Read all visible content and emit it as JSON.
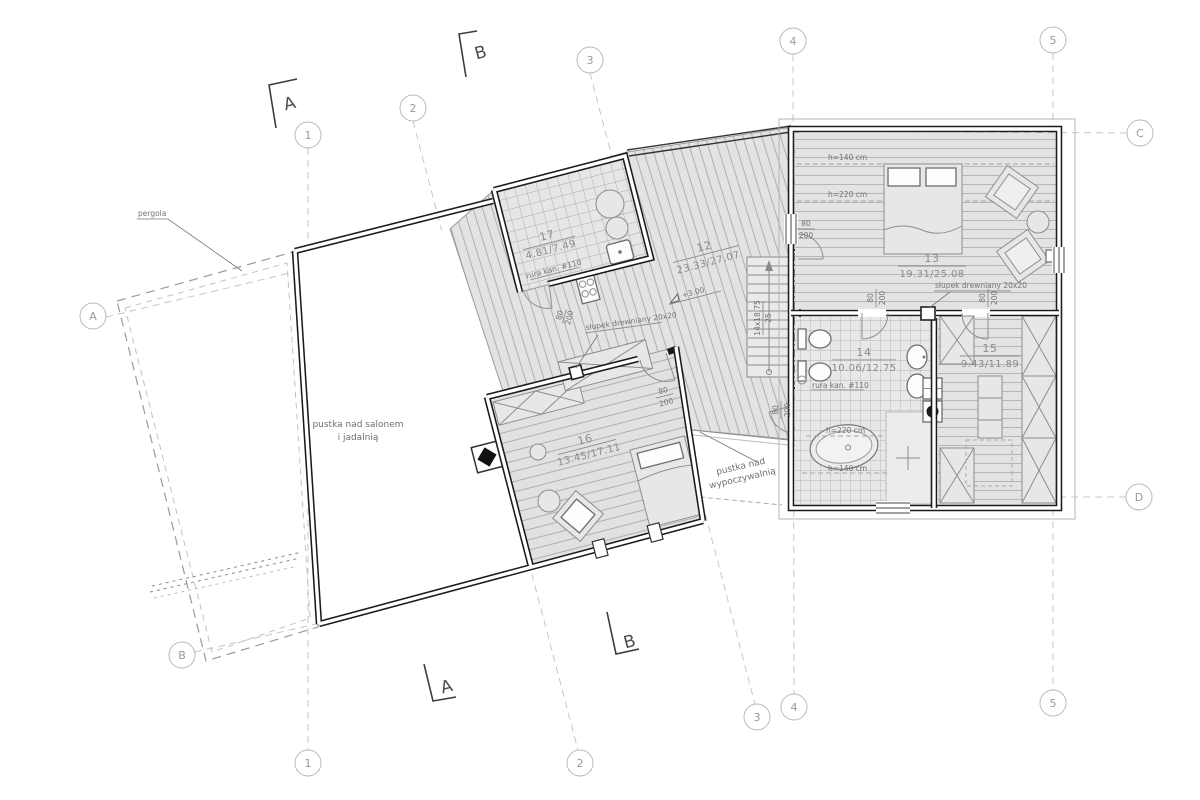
{
  "drawing": {
    "title": "floor-plan-attic-level",
    "grid": {
      "g1": "1",
      "g2": "2",
      "g3": "3",
      "g4": "4",
      "g5": "5",
      "ga": "A",
      "gb": "B",
      "gc": "C",
      "gd": "D"
    },
    "section": {
      "a": "A",
      "b": "B"
    },
    "rooms": {
      "r12": {
        "no": "12",
        "area": "23.33/27.07"
      },
      "r13": {
        "no": "13",
        "area": "19.31/25.08"
      },
      "r14": {
        "no": "14",
        "area": "10.06/12.75"
      },
      "r15": {
        "no": "15",
        "area": "9.43/11.89"
      },
      "r16": {
        "no": "16",
        "area": "13.45/17.11"
      },
      "r17": {
        "no": "17",
        "area": "4.81/7.49"
      }
    },
    "labels": {
      "pergola": "pergola",
      "void_salon_1": "pustka nad salonem",
      "void_salon_2": "i jadalnią",
      "void_lounge_1": "pustka nad",
      "void_lounge_2": "wypoczywalnią",
      "level": "+3.00",
      "stairs_steps": "14x18,75",
      "stairs_tread": "25",
      "post": "słupek drewniany 20x20",
      "pipe": "rura kan. #110",
      "h140": "h=140 cm",
      "h220": "h=220 cm"
    },
    "door": {
      "w": "80",
      "h": "200"
    },
    "colors": {
      "wall": "#1b1b1b",
      "floor": "#e3e3e3",
      "hatch_line": "#a9a9a9",
      "grid_line": "#c7c7c7",
      "text": "#8b8b8b"
    }
  }
}
